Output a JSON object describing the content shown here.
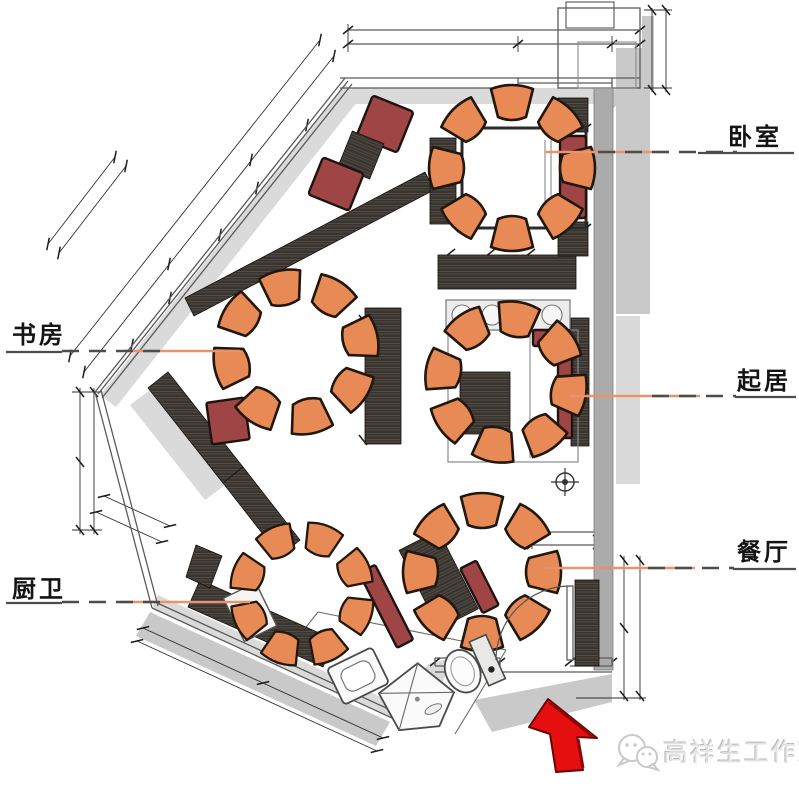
{
  "plan": {
    "type": "residential-floor-plan",
    "rooms": [
      {
        "id": "bedroom",
        "label": "卧室",
        "label_side": "right",
        "seats": 8
      },
      {
        "id": "study",
        "label": "书房",
        "label_side": "left",
        "seats": 8
      },
      {
        "id": "living",
        "label": "起居",
        "label_side": "right",
        "seats": 8
      },
      {
        "id": "dining",
        "label": "餐厅",
        "label_side": "right",
        "seats": 8
      },
      {
        "id": "kitchen-bath",
        "label": "厨卫",
        "label_side": "left",
        "seats": 8
      }
    ]
  },
  "entrance": {
    "indicator": "entrance-arrow",
    "direction": "up-left"
  },
  "symbols": {
    "marker": "crosshair-marker",
    "door": "door-swing-arc"
  },
  "watermark": {
    "studio_name": "高祥生工作室",
    "icon": "wechat-icon"
  },
  "colors": {
    "chair": "#e78a55",
    "red_seat": "#a04545",
    "wall_dark": "#39342f",
    "shadow": "#c9c9c9",
    "leader_orange": "#e8926e",
    "leader_dark": "#4d4d4d",
    "arrow_red": "#e60f0f",
    "label_text": "#141414",
    "watermark_gray": "#e2e2e0"
  }
}
